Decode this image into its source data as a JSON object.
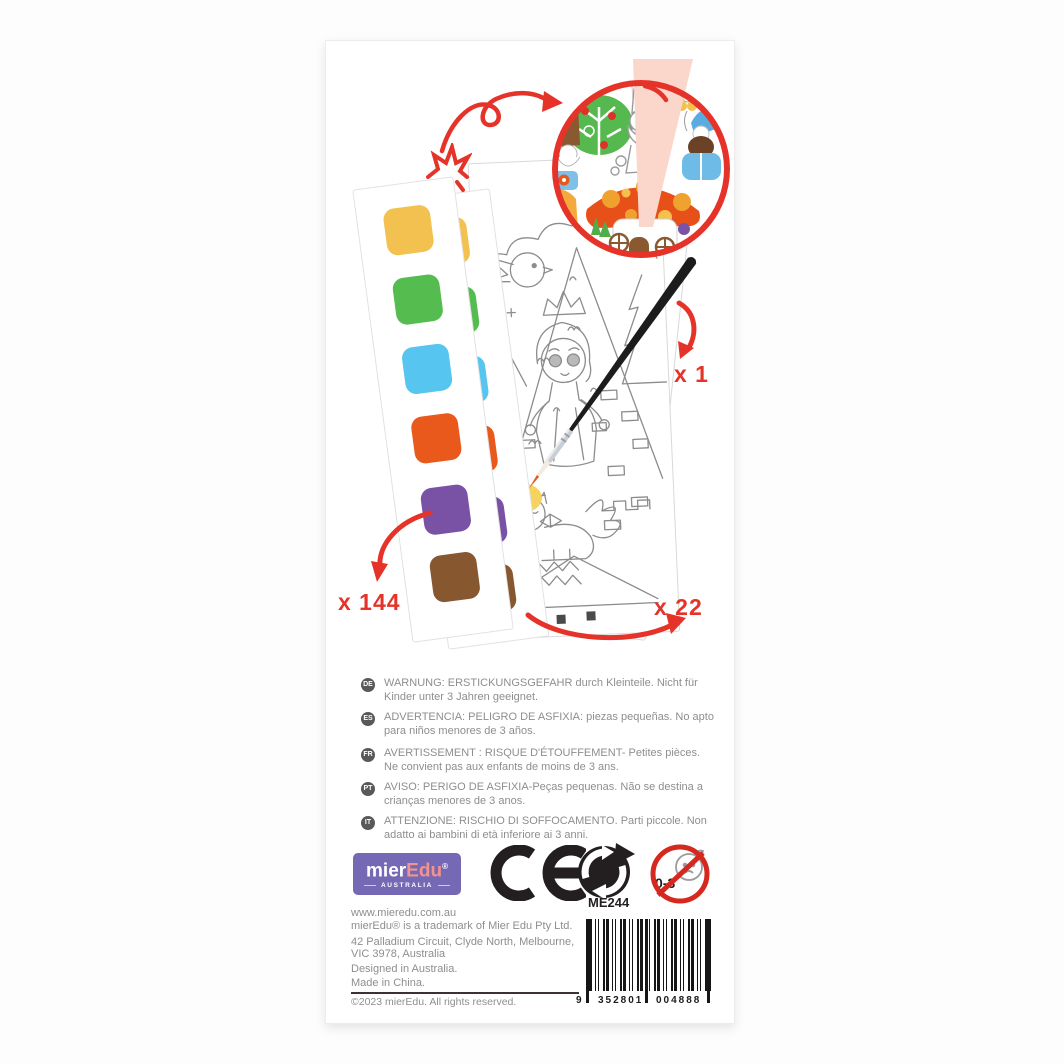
{
  "product": {
    "quantity_brush": "x 1",
    "quantity_paints": "x 144",
    "quantity_sheets": "x 22"
  },
  "palette_colors": [
    "#F2C150",
    "#55BD50",
    "#56C5F0",
    "#E8591B",
    "#7952A6",
    "#875730"
  ],
  "warnings": [
    {
      "lang": "DE",
      "text": "WARNUNG: ERSTICKUNGSGEFAHR durch Kleinteile. Nicht für Kinder unter 3 Jahren geeignet."
    },
    {
      "lang": "ES",
      "text": "ADVERTENCIA: PELIGRO DE ASFIXIA: piezas pequeñas. No apto para niños menores de 3 años."
    },
    {
      "lang": "FR",
      "text": "AVERTISSEMENT : RISQUE D'ÉTOUFFEMENT- Petites pièces. Ne convient pas aux enfants de moins de 3 ans."
    },
    {
      "lang": "PT",
      "text": "AVISO: PERIGO DE ASFIXIA-Peças pequenas. Não se destina a crianças menores de 3 anos."
    },
    {
      "lang": "IT",
      "text": "ATTENZIONE: RISCHIO DI SOFFOCAMENTO. Parti piccole. Non adatto ai bambini di età inferiore ai 3 anni."
    }
  ],
  "brand": {
    "logo_mier": "mier",
    "logo_edu": "Edu",
    "logo_reg": "®",
    "logo_country": "AUSTRALIA"
  },
  "marks": {
    "ce": "CE",
    "age_label": "0-3",
    "sku": "ME244"
  },
  "barcode": {
    "left_digit": "9",
    "group1": "352801",
    "group2": "004888"
  },
  "footer": {
    "website": "www.mieredu.com.au",
    "trademark": "mierEdu® is a trademark of Mier Edu Pty Ltd.",
    "address_line1": "42 Palladium Circuit, Clyde North, Melbourne,",
    "address_line2": "VIC 3978, Australia",
    "designed": "Designed in Australia.",
    "made": "Made in China.",
    "copyright": "©2023 mierEdu. All rights reserved."
  }
}
